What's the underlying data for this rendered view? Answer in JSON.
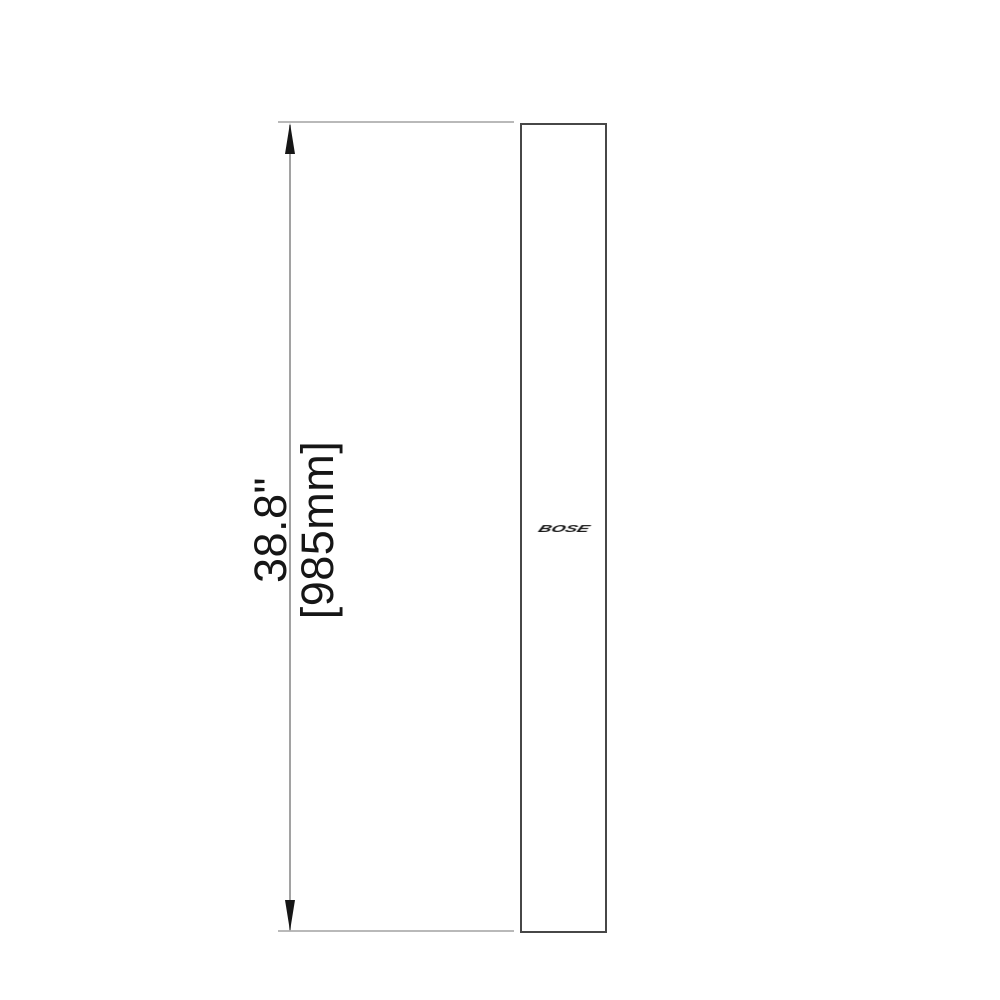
{
  "diagram": {
    "type": "product-dimension-drawing",
    "subject": "tall slim speaker, front elevation",
    "dimension": {
      "inches": "38.8\"",
      "millimeters": "[985mm]",
      "axis": "height"
    },
    "logo_text": "BOSE",
    "colors": {
      "background": "#ffffff",
      "extension_line": "#b9b9b9",
      "dimension_line": "#a2a2a2",
      "arrow": "#161616",
      "outline": "#474747",
      "text": "#161616"
    }
  }
}
